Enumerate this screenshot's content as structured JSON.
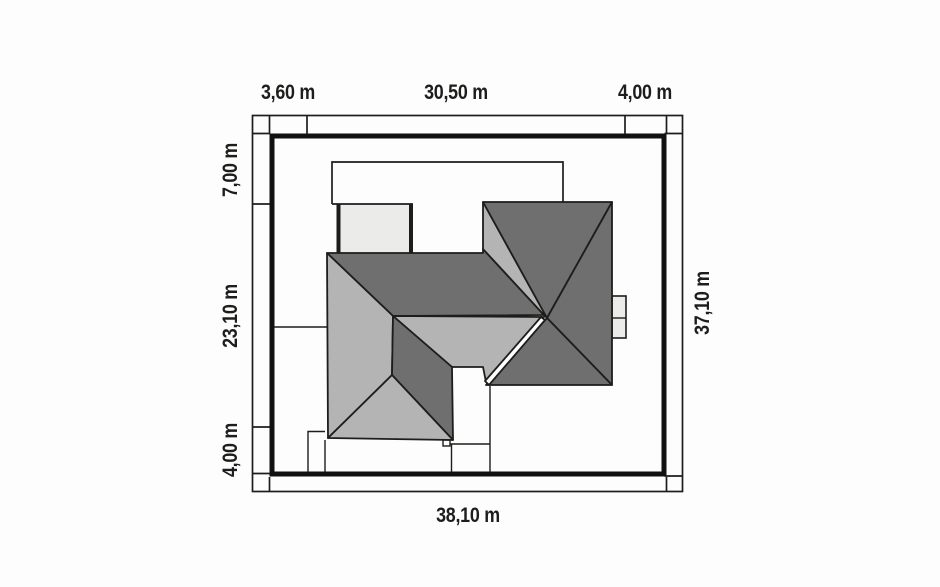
{
  "plan": {
    "type": "architectural-site-plan-roof-view",
    "colors": {
      "roof_dark": "#6f6f6f",
      "roof_light": "#b4b4b4",
      "pale_fill": "#ebebe9",
      "line": "#1d1d1b",
      "boundary": "#111111",
      "paper": "#fdfdfd",
      "white": "#ffffff"
    },
    "dimensions": {
      "top": [
        {
          "label": "3,60 m"
        },
        {
          "label": "30,50 m"
        },
        {
          "label": "4,00 m"
        }
      ],
      "left": [
        {
          "label": "7,00 m"
        },
        {
          "label": "23,10 m"
        },
        {
          "label": "4,00 m"
        }
      ],
      "right": [
        {
          "label": "37,10 m"
        }
      ],
      "bottom": [
        {
          "label": "38,10 m"
        }
      ]
    }
  }
}
